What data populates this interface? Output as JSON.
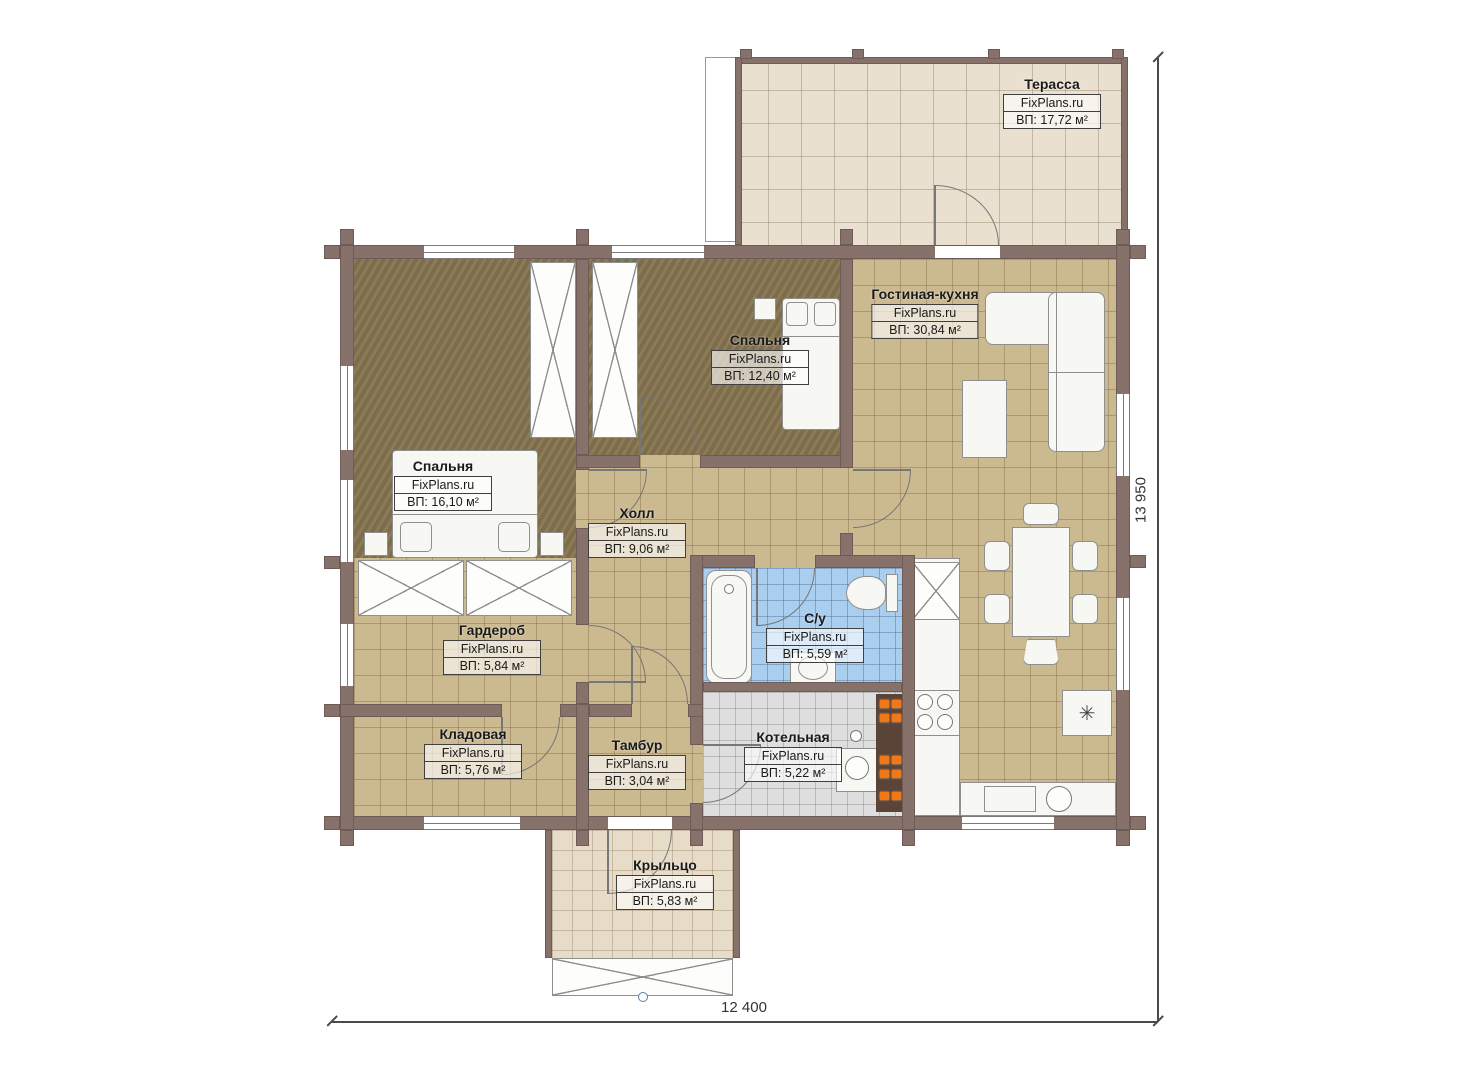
{
  "watermark": "FixPlans.ru",
  "rooms": [
    {
      "id": "terrace",
      "name": "Терасса",
      "area": "ВП: 17,72 м²"
    },
    {
      "id": "living",
      "name": "Гостиная-кухня",
      "area": "ВП: 30,84 м²"
    },
    {
      "id": "bedroom2",
      "name": "Спальня",
      "area": "ВП: 12,40 м²"
    },
    {
      "id": "bedroom1",
      "name": "Спальня",
      "area": "ВП: 16,10 м²"
    },
    {
      "id": "hall",
      "name": "Холл",
      "area": "ВП: 9,06 м²"
    },
    {
      "id": "bathroom",
      "name": "С/у",
      "area": "ВП: 5,59 м²"
    },
    {
      "id": "wardrobe",
      "name": "Гардероб",
      "area": "ВП: 5,84 м²"
    },
    {
      "id": "storage",
      "name": "Кладовая",
      "area": "ВП: 5,76 м²"
    },
    {
      "id": "tambur",
      "name": "Тамбур",
      "area": "ВП: 3,04 м²"
    },
    {
      "id": "boiler",
      "name": "Котельная",
      "area": "ВП: 5,22 м²"
    },
    {
      "id": "porch",
      "name": "Крыльцо",
      "area": "ВП: 5,83 м²"
    }
  ],
  "dimensions": {
    "width": "12 400",
    "height": "13 950"
  },
  "icons": {
    "hob_symbol": "✳"
  },
  "colors": {
    "wall": "#86716b",
    "floor_tile": "#cbb98f",
    "floor_bedroom": "#867450",
    "floor_bath": "#a9ceee",
    "floor_boiler": "#dedede",
    "floor_deck": "#e9e0cf",
    "heater_accent": "#f07818"
  }
}
